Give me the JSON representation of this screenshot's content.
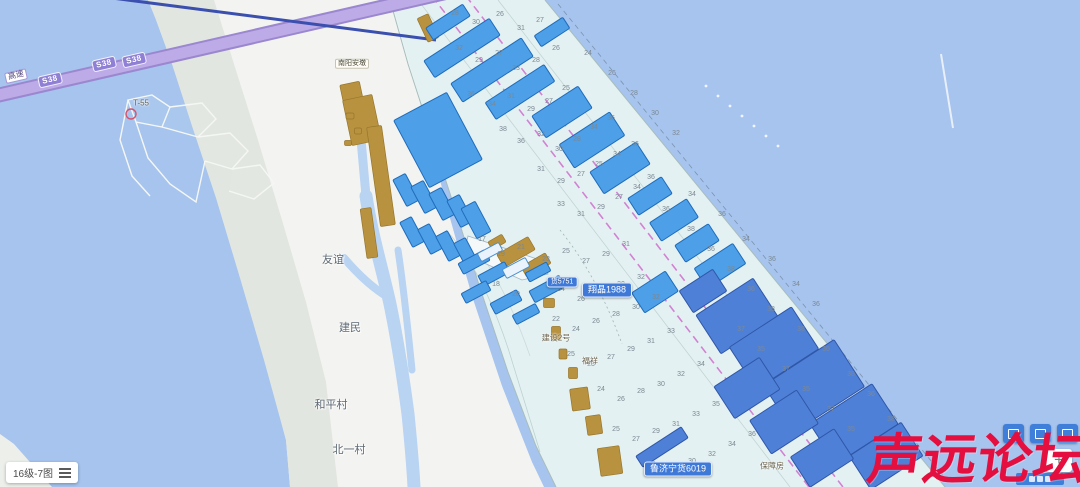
{
  "app": {
    "watermark": {
      "text": "声远论坛",
      "color": "#e50f3f"
    },
    "scale_control": {
      "label": "16级-7图",
      "icon": "menu-icon"
    },
    "zoom_controls": {
      "zoom_in_label": "+"
    },
    "toolbar_buttons": [
      {
        "icon": "layers-icon"
      },
      {
        "icon": "frame-icon"
      },
      {
        "icon": "marker-icon"
      }
    ]
  },
  "map": {
    "colors": {
      "water": "#a6c4ee",
      "chart_overlay": "#e6f2f1",
      "ship_parcel": "#4d9fe8",
      "spoil_area": "#b8923f",
      "channel_line": "#cf6ece",
      "highway": "#9b87cf"
    },
    "highway": {
      "shield_text": "S38",
      "entrance_label": "高速",
      "shields": [
        {
          "x": 50,
          "y": 80
        },
        {
          "x": 104,
          "y": 64
        },
        {
          "x": 134,
          "y": 60
        }
      ]
    },
    "ship_badges": [
      {
        "text": "货5751",
        "x": 562,
        "y": 282,
        "small": true
      },
      {
        "text": "翔晶1988",
        "x": 607,
        "y": 290
      },
      {
        "text": "鲁济宁货6019",
        "x": 678,
        "y": 469
      }
    ],
    "village_labels": [
      {
        "text": "友谊",
        "x": 333,
        "y": 259
      },
      {
        "text": "建民",
        "x": 350,
        "y": 327
      },
      {
        "text": "和平村",
        "x": 331,
        "y": 404
      },
      {
        "text": "北一村",
        "x": 349,
        "y": 449
      }
    ],
    "poi_labels": [
      {
        "text": "建设2号",
        "x": 556,
        "y": 338
      },
      {
        "text": "福祥",
        "x": 590,
        "y": 361
      },
      {
        "text": "保障房",
        "x": 772,
        "y": 466
      },
      {
        "text": "T-55",
        "x": 141,
        "y": 103
      }
    ],
    "boxed_labels": [
      {
        "text": "南阳安墩",
        "x": 352,
        "y": 64
      }
    ],
    "soundings": [
      [
        455,
        15,
        "28"
      ],
      [
        476,
        24,
        "30"
      ],
      [
        500,
        16,
        "26"
      ],
      [
        521,
        30,
        "31"
      ],
      [
        540,
        22,
        "27"
      ],
      [
        459,
        50,
        "32"
      ],
      [
        479,
        62,
        "29"
      ],
      [
        499,
        55,
        "27"
      ],
      [
        516,
        70,
        "33"
      ],
      [
        536,
        62,
        "28"
      ],
      [
        556,
        50,
        "26"
      ],
      [
        471,
        96,
        "36"
      ],
      [
        492,
        106,
        "34"
      ],
      [
        511,
        98,
        "31"
      ],
      [
        531,
        111,
        "29"
      ],
      [
        549,
        103,
        "27"
      ],
      [
        566,
        90,
        "25"
      ],
      [
        503,
        131,
        "38"
      ],
      [
        521,
        143,
        "36"
      ],
      [
        541,
        136,
        "32"
      ],
      [
        559,
        151,
        "30"
      ],
      [
        577,
        141,
        "28"
      ],
      [
        594,
        129,
        "34"
      ],
      [
        611,
        120,
        "36"
      ],
      [
        541,
        171,
        "31"
      ],
      [
        561,
        183,
        "29"
      ],
      [
        581,
        176,
        "27"
      ],
      [
        599,
        166,
        "25"
      ],
      [
        617,
        156,
        "34"
      ],
      [
        635,
        146,
        "36"
      ],
      [
        561,
        206,
        "33"
      ],
      [
        581,
        216,
        "31"
      ],
      [
        601,
        209,
        "29"
      ],
      [
        619,
        199,
        "27"
      ],
      [
        637,
        189,
        "34"
      ],
      [
        651,
        179,
        "36"
      ],
      [
        482,
        241,
        "17"
      ],
      [
        501,
        256,
        "19"
      ],
      [
        521,
        249,
        "21"
      ],
      [
        546,
        261,
        "23"
      ],
      [
        566,
        253,
        "25"
      ],
      [
        586,
        263,
        "27"
      ],
      [
        606,
        256,
        "29"
      ],
      [
        626,
        246,
        "31"
      ],
      [
        496,
        286,
        "18"
      ],
      [
        516,
        296,
        "20"
      ],
      [
        561,
        291,
        "24"
      ],
      [
        581,
        301,
        "26"
      ],
      [
        601,
        293,
        "28"
      ],
      [
        621,
        286,
        "30"
      ],
      [
        641,
        279,
        "32"
      ],
      [
        556,
        321,
        "22"
      ],
      [
        576,
        331,
        "24"
      ],
      [
        596,
        323,
        "26"
      ],
      [
        616,
        316,
        "28"
      ],
      [
        636,
        309,
        "30"
      ],
      [
        656,
        299,
        "32"
      ],
      [
        571,
        356,
        "25"
      ],
      [
        591,
        366,
        "23"
      ],
      [
        611,
        359,
        "27"
      ],
      [
        631,
        351,
        "29"
      ],
      [
        651,
        343,
        "31"
      ],
      [
        671,
        333,
        "33"
      ],
      [
        601,
        391,
        "24"
      ],
      [
        621,
        401,
        "26"
      ],
      [
        641,
        393,
        "28"
      ],
      [
        661,
        386,
        "30"
      ],
      [
        681,
        376,
        "32"
      ],
      [
        701,
        366,
        "34"
      ],
      [
        616,
        431,
        "25"
      ],
      [
        636,
        441,
        "27"
      ],
      [
        656,
        433,
        "29"
      ],
      [
        676,
        426,
        "31"
      ],
      [
        696,
        416,
        "33"
      ],
      [
        716,
        406,
        "35"
      ],
      [
        652,
        466,
        "26"
      ],
      [
        672,
        473,
        "28"
      ],
      [
        692,
        463,
        "30"
      ],
      [
        712,
        456,
        "32"
      ],
      [
        732,
        446,
        "34"
      ],
      [
        752,
        436,
        "36"
      ],
      [
        666,
        211,
        "36"
      ],
      [
        691,
        231,
        "38"
      ],
      [
        711,
        251,
        "36"
      ],
      [
        731,
        271,
        "38"
      ],
      [
        751,
        291,
        "36"
      ],
      [
        771,
        311,
        "38"
      ],
      [
        692,
        196,
        "34"
      ],
      [
        722,
        216,
        "36"
      ],
      [
        746,
        241,
        "34"
      ],
      [
        772,
        261,
        "36"
      ],
      [
        796,
        286,
        "34"
      ],
      [
        816,
        306,
        "36"
      ],
      [
        741,
        331,
        "37"
      ],
      [
        761,
        351,
        "35"
      ],
      [
        786,
        371,
        "37"
      ],
      [
        806,
        391,
        "35"
      ],
      [
        831,
        411,
        "37"
      ],
      [
        851,
        431,
        "35"
      ],
      [
        801,
        331,
        "38"
      ],
      [
        826,
        351,
        "36"
      ],
      [
        851,
        376,
        "38"
      ],
      [
        871,
        396,
        "36"
      ],
      [
        891,
        421,
        "38"
      ],
      [
        588,
        55,
        "24"
      ],
      [
        612,
        75,
        "26"
      ],
      [
        634,
        95,
        "28"
      ],
      [
        655,
        115,
        "30"
      ],
      [
        676,
        135,
        "32"
      ]
    ],
    "ship_parcels": [
      [
        448,
        22,
        44,
        14,
        -33
      ],
      [
        462,
        48,
        78,
        20,
        -33
      ],
      [
        492,
        70,
        84,
        22,
        -33
      ],
      [
        520,
        92,
        70,
        20,
        -33
      ],
      [
        552,
        32,
        34,
        13,
        -33
      ],
      [
        562,
        112,
        55,
        26,
        -33
      ],
      [
        592,
        140,
        60,
        28,
        -33
      ],
      [
        620,
        168,
        55,
        26,
        -33
      ],
      [
        650,
        196,
        40,
        20,
        -33
      ],
      [
        674,
        220,
        44,
        22,
        -33
      ],
      [
        697,
        243,
        40,
        20,
        -33
      ],
      [
        720,
        266,
        46,
        24,
        -33
      ],
      [
        438,
        140,
        60,
        76,
        -28
      ],
      [
        406,
        190,
        14,
        30,
        -28
      ],
      [
        424,
        197,
        14,
        30,
        -28
      ],
      [
        442,
        204,
        14,
        30,
        -28
      ],
      [
        460,
        211,
        14,
        30,
        -28
      ],
      [
        476,
        220,
        16,
        34,
        -28
      ],
      [
        412,
        232,
        13,
        28,
        -28
      ],
      [
        430,
        239,
        13,
        28,
        -28
      ],
      [
        448,
        246,
        13,
        28,
        -28
      ],
      [
        466,
        253,
        13,
        28,
        -28
      ],
      [
        474,
        262,
        30,
        12,
        -28
      ],
      [
        494,
        274,
        30,
        12,
        -28
      ],
      [
        476,
        292,
        28,
        11,
        -28
      ],
      [
        506,
        302,
        30,
        12,
        -28
      ],
      [
        526,
        314,
        26,
        10,
        -28
      ],
      [
        547,
        289,
        34,
        13,
        -28
      ],
      [
        538,
        272,
        24,
        10,
        -28
      ],
      [
        516,
        268,
        26,
        10,
        -28,
        "h"
      ],
      [
        490,
        252,
        24,
        9,
        -28,
        "h"
      ],
      [
        655,
        292,
        40,
        24,
        -33
      ],
      [
        703,
        291,
        40,
        26,
        -33,
        "d"
      ],
      [
        737,
        316,
        68,
        46,
        -33,
        "d"
      ],
      [
        774,
        348,
        74,
        50,
        -33,
        "d"
      ],
      [
        814,
        386,
        84,
        56,
        -33,
        "d"
      ],
      [
        854,
        424,
        74,
        48,
        -33,
        "d"
      ],
      [
        886,
        456,
        62,
        40,
        -33,
        "d"
      ],
      [
        747,
        388,
        54,
        38,
        -33,
        "d"
      ],
      [
        784,
        422,
        56,
        40,
        -33,
        "d"
      ],
      [
        822,
        458,
        52,
        36,
        -33,
        "d"
      ],
      [
        662,
        447,
        54,
        13,
        -33,
        "d"
      ]
    ],
    "spoil_areas": [
      [
        352,
        95,
        20,
        24,
        -12
      ],
      [
        362,
        120,
        30,
        46,
        -12
      ],
      [
        381,
        176,
        15,
        100,
        -8
      ],
      [
        369,
        233,
        11,
        50,
        -8
      ],
      [
        350,
        116,
        8,
        6,
        0
      ],
      [
        358,
        131,
        7,
        6,
        0
      ],
      [
        348,
        143,
        7,
        5,
        0
      ],
      [
        428,
        28,
        12,
        26,
        -25
      ],
      [
        497,
        242,
        16,
        9,
        -30
      ],
      [
        516,
        252,
        36,
        15,
        -30
      ],
      [
        536,
        265,
        28,
        12,
        -30
      ],
      [
        549,
        303,
        11,
        9,
        0
      ],
      [
        556,
        333,
        9,
        13,
        0
      ],
      [
        563,
        354,
        8,
        10,
        0
      ],
      [
        573,
        373,
        9,
        11,
        0
      ],
      [
        580,
        399,
        18,
        22,
        -8
      ],
      [
        594,
        425,
        15,
        19,
        -8
      ],
      [
        610,
        461,
        22,
        28,
        -8
      ]
    ]
  }
}
